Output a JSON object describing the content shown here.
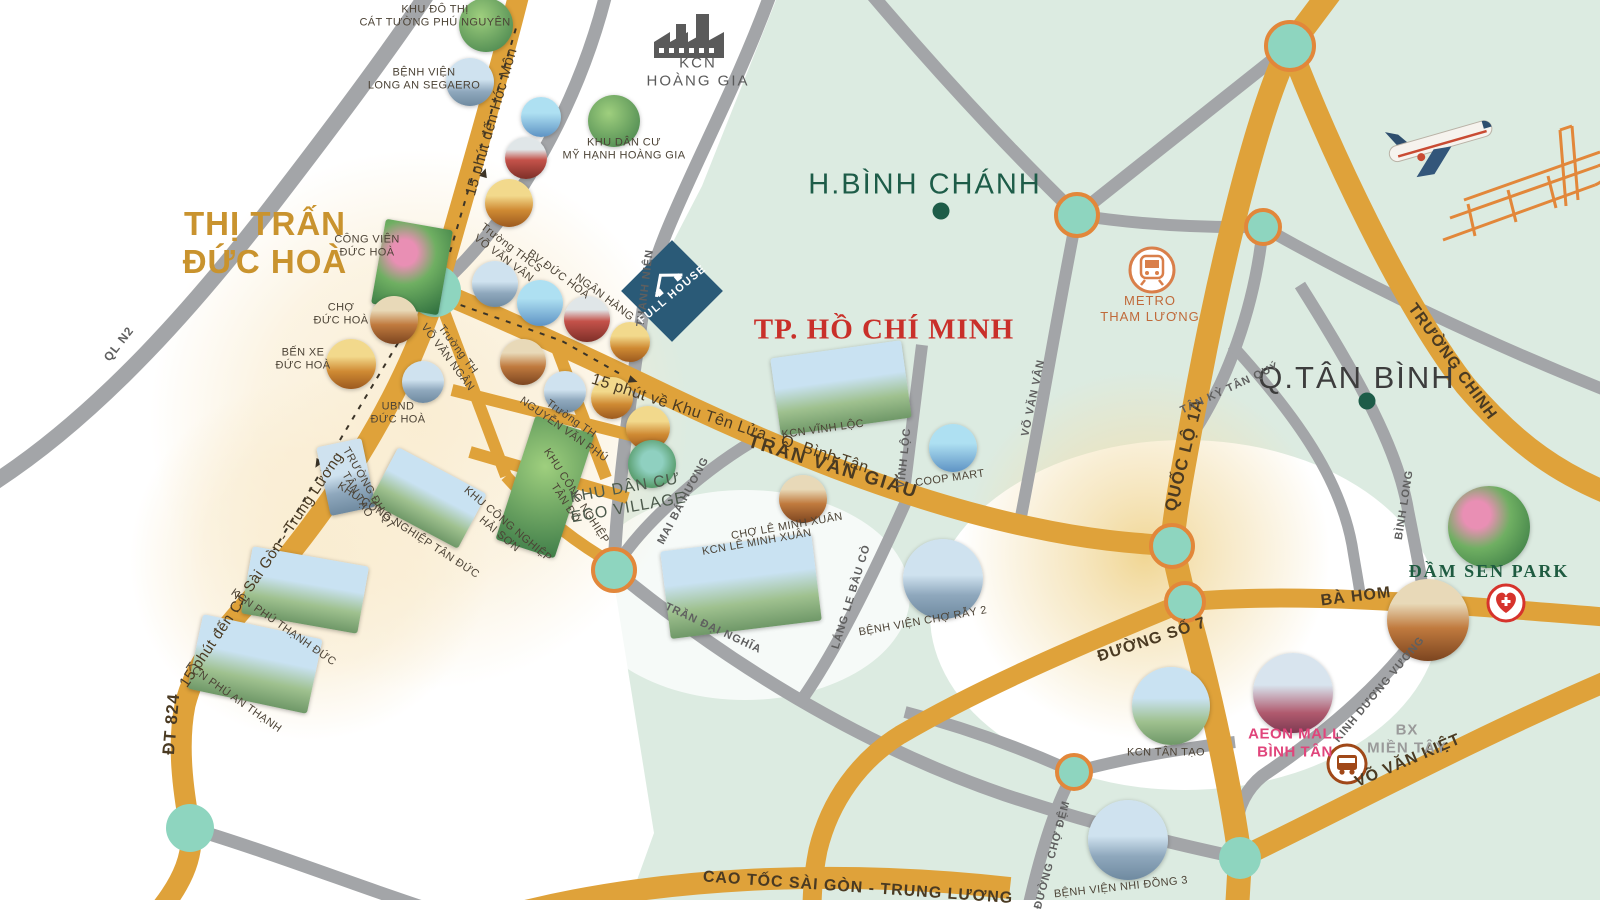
{
  "areas": {
    "thi_tran_duc_hoa": "THỊ TRẤN\nĐỨC HOÀ",
    "h_binh_chanh": "H.BÌNH CHÁNH",
    "tp_ho_chi_minh": "TP. HỒ CHÍ MINH",
    "q_tan_binh": "Q.TÂN BÌNH"
  },
  "roads": {
    "ql_n2": "QL N2",
    "thanh_nien": "THANH NIÊN",
    "tran_van_giau": "TRẦN VĂN GIÀU",
    "dt_824": "ĐT 824",
    "quoc_lo_1a": "QUỐC LỘ 1A",
    "truong_chinh": "TRƯỜNG CHINH",
    "ba_hom": "BÀ HOM",
    "duong_so_7": "ĐƯỜNG SỐ 7",
    "vo_van_kiet": "VÕ VĂN KIỆT",
    "cao_toc": "CAO TỐC SÀI GÒN - TRUNG LƯƠNG",
    "vinh_loc": "VĨNH LỘC",
    "vo_van_van": "VÕ VĂN VÂN",
    "mai_ba_huong": "MAI BÁ HƯƠNG",
    "tran_dai_nghia": "TRẦN ĐẠI NGHĨA",
    "lang_le_bau_co": "LÁNG LE BÀU CÒ",
    "tan_ky_tan_quy": "TÂN KỲ TÂN QUÝ",
    "binh_long": "BÌNH LONG",
    "kinh_duong_vuong": "KINH DƯƠNG VƯƠNG",
    "duong_cho_dem": "ĐƯỜNG CHỢ ĐỆM"
  },
  "routes": {
    "hoc_mon": "15 phút đến Hóc Môn",
    "khu_ten_lua": "15 phút về Khu Tên Lửa - Q. Bình Tân",
    "ct_sai_gon": "15 phút đến CT Sài Gòn - Trung Lương"
  },
  "pois": {
    "kdt_cat_tuong": "KHU ĐÔ THỊ\nCÁT TƯỜNG PHÚ NGUYÊN",
    "bv_long_an": "BỆNH VIỆN\nLONG AN SEGAERO",
    "kcn_hoang_gia": "KCN\nHOÀNG GIA",
    "kdc_my_hanh": "KHU DÂN CƯ\nMỸ HẠNH HOÀNG GIA",
    "cong_vien_duc_hoa": "CÔNG VIÊN\nĐỨC HOÀ",
    "cho_duc_hoa": "CHỢ\nĐỨC HOÀ",
    "ben_xe_duc_hoa": "BẾN XE\nĐỨC HOÀ",
    "ubnd_duc_hoa": "UBND\nĐỨC HOÀ",
    "thcs_vo_van_van": "Trường THCS\nVÕ VĂN VÂN",
    "bv_duc_hoa": "BV ĐỨC HOÀ",
    "ngan_hang": "NGÂN HÀNG",
    "th_vo_van_ngan": "Trường TH\nVÕ VĂN NGÂN",
    "th_nguyen_van_phu": "Trường TH\nNGUYỄN VĂN PHÚ",
    "dh_qt_tan_tao": "TRƯỜNG ĐH QT\nTÂN TẠO",
    "kcn_tan_duc": "KHU CÔNG NGHIỆP TÂN ĐỨC",
    "kcn_hai_son": "KHU CÔNG NGHIỆP\nHẢI SƠN",
    "kcn_tan_do": "KHU CÔNG NGHIỆP\nTÂN ĐÔ",
    "kcn_phu_thanh_duc": "KCN PHÚ THẠNH ĐỨC",
    "kcn_phu_an_thanh": "KCN PHÚ AN THẠNH",
    "kdc_eco_village": "KHU DÂN CƯ\nECO VILLAGE",
    "kcn_vinh_loc": "KCN VĨNH LỘC",
    "coop_mart": "COOP MART",
    "cho_le_minh_xuan": "CHỢ LÊ MINH XUÂN",
    "kcn_le_minh_xuan": "KCN LÊ MINH XUÂN",
    "bv_cho_ray_2": "BỆNH VIỆN CHỢ RẪY 2",
    "metro_tham_luong": "METRO\nTHAM LƯƠNG",
    "kcn_tan_tao": "KCN TÂN TẠO",
    "aeon_mall": "AEON MALL\nBÌNH TÂN",
    "bx_mien_tay": "BX\nMIỀN TÂY",
    "bv_nhi_dong_3": "BỆNH VIỆN NHI ĐỒNG 3",
    "dam_sen_park": "ĐẦM SEN PARK"
  },
  "logo": {
    "full_house": "FULL HOUSE"
  },
  "colors": {
    "orange_road": "#dfa23a",
    "gray_road": "#a3a5a8",
    "green_area": "#dcebe1",
    "node_teal": "#8ed5bf",
    "node_ring": "#e2873a",
    "title_gold": "#c9932e",
    "title_red": "#c9302a",
    "title_green": "#1d5c48",
    "aeon_pink": "#e0457b"
  }
}
